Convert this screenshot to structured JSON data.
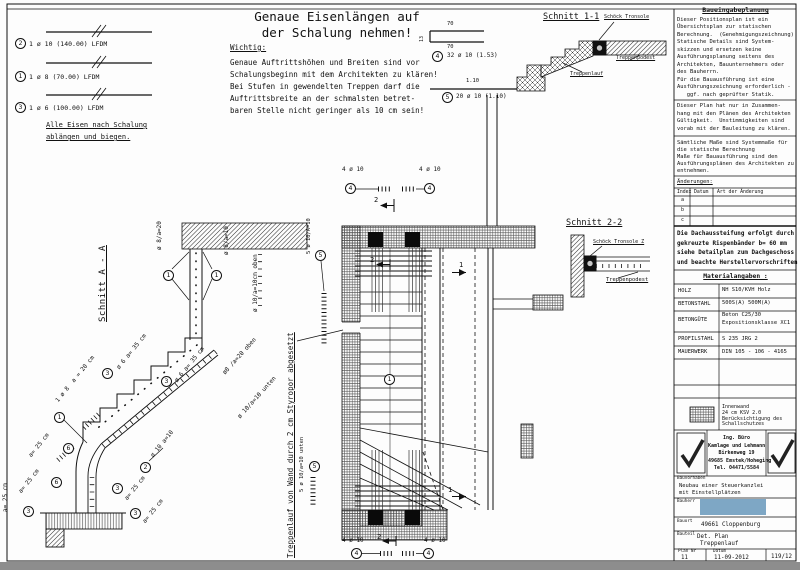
{
  "legend": {
    "item1_pos": "2",
    "item1_text": "1 ø 10 (140.00) LFDM",
    "item2_pos": "1",
    "item2_text": "1 ø 8 (70.00) LFDM",
    "item3_pos": "3",
    "item3_text": "1 ø 6 (100.00) LFDM",
    "note1": "Alle Eisen nach Schalung",
    "note2": "ablängen und biegen."
  },
  "header": {
    "title1": "Genaue Eisenlängen auf",
    "title2": "der Schalung nehmen!",
    "wichtig": "Wichtig:",
    "body": [
      "Genaue Auftrittshöhen und Breiten sind vor",
      "Schalungsbeginn mit dem Architekten zu klären!",
      "Bei Stufen in gewendelten Treppen darf die",
      "Auftrittsbreite an der schmalsten betret-",
      "baren Stelle nicht geringer als 10 cm sein!"
    ]
  },
  "bars": {
    "b4_dim_top": "70",
    "b4_dim_bottom": "70",
    "b4_dim_left": "13",
    "b4_pos": "4",
    "b4_text": "32 ø 10 (1.53)",
    "b5_dim": "1.10",
    "b5_pos": "5",
    "b5_text": "20 ø 10 (1.10)"
  },
  "schnitt11": {
    "title": "Schnitt 1-1",
    "tronsole": "Schöck Tronsole",
    "podest": "Treppenpodest",
    "lauf": "Treppenlauf"
  },
  "schnitt22": {
    "title": "Schnitt 2-2",
    "tronsole": "Schöck Tronsole Z",
    "podest": "Treppenpodest"
  },
  "section": {
    "title": "Schnitt A - A",
    "m1_pos": "1",
    "m1_text": "ø 8/a=20",
    "m2_pos": "1",
    "m2_text": "ø 8/a=10",
    "m3_text": "ø 10/a=10cm oben",
    "m4_pos": "3",
    "m4_text": "ø 6 a= 35 cm",
    "m5_pos": "3",
    "m5_text": "ø 6 a= 35 cm",
    "m6_text": "1 ø 8  a = 20 cm",
    "m7_text": "ø8 /a=20 oben",
    "m8_text": "ø 10/a=10 unten",
    "m9_pos": "2",
    "m9_text": "ø 10 a=10",
    "m10_pos": "6",
    "m10_text": "a= 25 cm",
    "m11_pos": "6",
    "m11_text": "a= 25 cm",
    "m12_pos": "3",
    "m12_text": "a= 25 cm",
    "m13_pos": "3",
    "m13_text": "a= 25 cm",
    "m14_pos": "3",
    "m14_text": "a= 25 cm",
    "m15_pos": "1"
  },
  "plan": {
    "callout_text": "4 ø 10",
    "callout_pos": "4",
    "bar5_top_text": "5 ø 10/A=10",
    "bar5_top_pos": "5",
    "bar5_bot_text": "5 ø 10/a=10 unten",
    "bar5_bot_pos": "5",
    "pos1": "1",
    "cut1": "1",
    "cut2": "2",
    "styropor": "Treppenlauf von Wand durch 2 cm Styropor abgesetzt"
  },
  "info": {
    "title": "Baueingabeplanung",
    "p1": [
      "Dieser Positionsplan ist ein",
      "Übersichtsplan zur statischen",
      "Berechnung.  (Genehmigungszeichnung)",
      "Statische Details sind System-",
      "skizzen und ersetzen keine",
      "Ausführungsplanung seitens des",
      "Architekten, Bauunternehmers oder",
      "des Bauherrn.",
      "Für die Bauausführung ist eine",
      "Ausführungszeichnung erforderlich -",
      "   ggf. nach geprüfter Statik."
    ],
    "p2": [
      "Dieser Plan hat nur in Zusammen-",
      "hang mit den Plänen des Architekten",
      "Gültigkeit.  Unstimmigkeiten sind",
      "vorab mit der Bauleitung zu klären."
    ],
    "p3": [
      "Sämtliche Maße sind Systemmaße für",
      "die statische Berechnung",
      "Maße für Bauausführung sind den",
      "Ausführungsplänen des Architekten zu",
      "entnehmen."
    ],
    "aenderungen_label": "Änderungen:",
    "aenderungen_headers": [
      "Index",
      "Datum",
      "Art der Änderung"
    ],
    "aenderungen_rows": [
      "a",
      "b",
      "c"
    ],
    "dach": [
      "Die Dachaussteifung erfolgt durch",
      "gekreuzte Rispenbänder b= 60 mm",
      "siehe Detailplan zum Dachgeschoss",
      "und beachte Herstellervorschriften"
    ],
    "mat_title": "Materialangaben :",
    "materials": [
      {
        "k": "HOLZ",
        "v1": "NH S10/KVH Holz",
        "v2": ""
      },
      {
        "k": "BETONSTAHL",
        "v1": "500S(A) 500M(A)",
        "v2": ""
      },
      {
        "k": "BETONGÜTE",
        "v1": "Beton C25/30",
        "v2": "Expositionsklasse XC1"
      },
      {
        "k": "PROFILSTAHL",
        "v1": "S 235 JRG 2",
        "v2": ""
      },
      {
        "k": "MAUERWERK",
        "v1": "DIN 105 - 106 - 4165",
        "v2": ""
      }
    ],
    "innenwand": [
      "Innenwand",
      "24 cm KSV 2.0",
      "Berücksichtigung des",
      "Schallschutzes"
    ],
    "firm": [
      "Ing. Büro",
      "Kamlage und Lehmann",
      "Birkenweg 19",
      "49685 Emstek/Hoheging",
      "Tel. 04471/5584"
    ]
  },
  "titleblock": {
    "bauvorhaben_label": "Bauvorhaben",
    "bauvorhaben1": "Neubau einer Steuerkanzlei",
    "bauvorhaben2": "mit Einstellplätzen",
    "bauherr_label": "Bauherr",
    "bauort_label": "Bauort",
    "bauort": "49661 Cloppenburg",
    "bauteil_label": "Bauteil",
    "bauteil1": "Det. Plan",
    "bauteil2": "Treppenlauf",
    "plannr_label": "Plan Nr",
    "datum_label": "Datum",
    "plannr": "11",
    "datum": "11-09-2012",
    "ref": "119/12"
  },
  "colors": {
    "redaction_blue": "#7ea7c5",
    "bottom_bar_gray": "#8d8d8d",
    "line_black": "#111111"
  }
}
